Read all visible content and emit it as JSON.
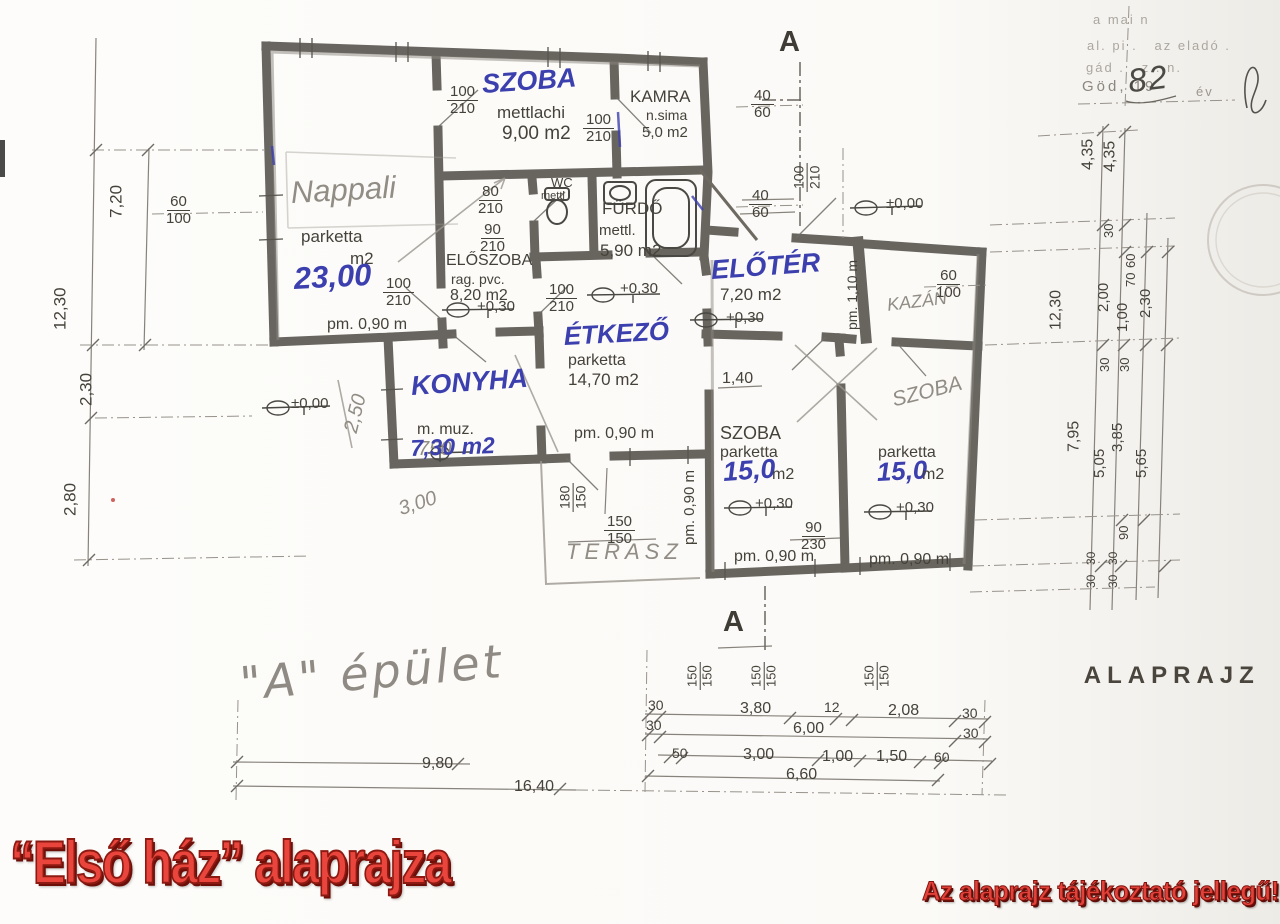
{
  "colors": {
    "red_text": "#e3423b",
    "red_shadow": "#7e120c",
    "blue_ink": "#3c3fae",
    "pencil_gray": "#918d85",
    "ink": "#45423a"
  },
  "footer": {
    "title": "“Első ház” alaprajza",
    "note": "Az alaprajz tájékoztató jellegű!"
  },
  "caption": {
    "label": "ALAPRAJZ",
    "scale": "( M"
  },
  "section_marker": "A",
  "building_label": "\"A\" épület",
  "scan_header": {
    "line1": "a mai n",
    "line2": "al. pi .   az eladó .",
    "line3": "gád . , z . n.",
    "date_prefix": "Göd, 19",
    "year": "82",
    "suffix": "év"
  },
  "annotations": [
    {
      "id": "szoba1-name",
      "text": "SZOBA",
      "x": 481,
      "y": 70,
      "size": 27,
      "cls": "blue",
      "rot": -4
    },
    {
      "id": "szoba1-finish",
      "text": "mettlachi",
      "x": 497,
      "y": 104,
      "size": 17
    },
    {
      "id": "szoba1-area",
      "text": "9,00 m2",
      "x": 502,
      "y": 124,
      "size": 19
    },
    {
      "id": "szoba1-door-size",
      "text": "100\n210",
      "x": 447,
      "y": 84,
      "size": 15,
      "frac": true
    },
    {
      "id": "kamra-door-size",
      "text": "100\n210",
      "x": 583,
      "y": 112,
      "size": 15,
      "frac": true
    },
    {
      "id": "kamra-name",
      "text": "KAMRA",
      "x": 630,
      "y": 88,
      "size": 17
    },
    {
      "id": "kamra-finish",
      "text": "n.sima",
      "x": 646,
      "y": 108,
      "size": 14
    },
    {
      "id": "kamra-area",
      "text": "5,0 m2",
      "x": 642,
      "y": 125,
      "size": 15
    },
    {
      "id": "nappali-name",
      "text": "Nappali",
      "x": 290,
      "y": 176,
      "size": 31,
      "cls": "pencil",
      "rot": -3
    },
    {
      "id": "nappali-finish",
      "text": "parketta",
      "x": 301,
      "y": 228,
      "size": 17
    },
    {
      "id": "nappali-area-unit",
      "text": "m2",
      "x": 350,
      "y": 250,
      "size": 17
    },
    {
      "id": "nappali-area",
      "text": "23,00",
      "x": 293,
      "y": 262,
      "size": 31,
      "cls": "blue",
      "rot": -3
    },
    {
      "id": "wc-door-size",
      "text": "80\n210",
      "x": 478,
      "y": 184,
      "size": 15,
      "frac": true
    },
    {
      "id": "wc-name",
      "text": "WC",
      "x": 551,
      "y": 176,
      "size": 13
    },
    {
      "id": "wc-finish",
      "text": "mettl",
      "x": 541,
      "y": 191,
      "size": 11
    },
    {
      "id": "furdo-name",
      "text": "FÜRDŐ",
      "x": 602,
      "y": 200,
      "size": 17
    },
    {
      "id": "furdo-finish",
      "text": "mettl.",
      "x": 599,
      "y": 223,
      "size": 15
    },
    {
      "id": "furdo-area",
      "text": "5,90 m2",
      "x": 600,
      "y": 242,
      "size": 17
    },
    {
      "id": "eloszoba-door-size",
      "text": "90\n210",
      "x": 480,
      "y": 222,
      "size": 15,
      "frac": true
    },
    {
      "id": "eloszoba-name",
      "text": "ELŐSZOBA",
      "x": 446,
      "y": 252,
      "size": 16
    },
    {
      "id": "eloszoba-finish",
      "text": "rag. pvc.",
      "x": 451,
      "y": 272,
      "size": 14
    },
    {
      "id": "eloszoba-area",
      "text": "8,20 m2",
      "x": 450,
      "y": 287,
      "size": 16
    },
    {
      "id": "eloszoba-level",
      "text": "+0,30",
      "x": 477,
      "y": 299,
      "size": 15
    },
    {
      "id": "nappali-door-size",
      "text": "100\n210",
      "x": 383,
      "y": 276,
      "size": 15,
      "frac": true
    },
    {
      "id": "etkezo-door-size",
      "text": "100\n210",
      "x": 546,
      "y": 282,
      "size": 15,
      "frac": true
    },
    {
      "id": "nappali-parapet",
      "text": "pm. 0,90 m",
      "x": 327,
      "y": 316,
      "size": 16
    },
    {
      "id": "etkezo-name",
      "text": "ÉTKEZŐ",
      "x": 563,
      "y": 322,
      "size": 26,
      "cls": "blue",
      "rot": -3
    },
    {
      "id": "etkezo-finish",
      "text": "parketta",
      "x": 568,
      "y": 352,
      "size": 16
    },
    {
      "id": "etkezo-area",
      "text": "14,70 m2",
      "x": 568,
      "y": 371,
      "size": 17
    },
    {
      "id": "etkezo-level",
      "text": "+0,30",
      "x": 620,
      "y": 281,
      "size": 15
    },
    {
      "id": "konyha-name",
      "text": "KONYHA",
      "x": 410,
      "y": 372,
      "size": 27,
      "cls": "blue",
      "rot": -4
    },
    {
      "id": "konyha-finish",
      "text": "m. muz.",
      "x": 417,
      "y": 421,
      "size": 16
    },
    {
      "id": "konyha-area-old",
      "text": "750",
      "x": 418,
      "y": 439,
      "size": 20,
      "cls": "pencil"
    },
    {
      "id": "konyha-area",
      "text": "7,30 m2",
      "x": 410,
      "y": 436,
      "size": 23,
      "cls": "blue",
      "rot": -2
    },
    {
      "id": "etkezo-parapet",
      "text": "pm. 0,90 m",
      "x": 574,
      "y": 425,
      "size": 16
    },
    {
      "id": "eloter-name",
      "text": "ELŐTÉR",
      "x": 710,
      "y": 256,
      "size": 27,
      "cls": "blue",
      "rot": -4
    },
    {
      "id": "eloter-area",
      "text": "7,20 m2",
      "x": 720,
      "y": 286,
      "size": 17
    },
    {
      "id": "eloter-level",
      "text": "+0,30",
      "x": 726,
      "y": 310,
      "size": 15
    },
    {
      "id": "entry-level",
      "text": "±0,00",
      "x": 886,
      "y": 196,
      "size": 15
    },
    {
      "id": "konyha-level",
      "text": "±0,00",
      "x": 291,
      "y": 396,
      "size": 15
    },
    {
      "id": "kazan-name",
      "text": "KAZÁN",
      "x": 886,
      "y": 296,
      "size": 18,
      "cls": "pencil",
      "rot": -7
    },
    {
      "id": "kazan-parapet",
      "text": "pm. 1,10 m",
      "x": 860,
      "y": 330,
      "size": 14,
      "rot": -90
    },
    {
      "id": "dim-4060-top",
      "text": "40\n60",
      "x": 751,
      "y": 88,
      "size": 15,
      "frac": true
    },
    {
      "id": "dim-4060-mid",
      "text": "40\n60",
      "x": 749,
      "y": 188,
      "size": 15,
      "frac": true
    },
    {
      "id": "kazan-window",
      "text": "60\n100",
      "x": 936,
      "y": 268,
      "size": 15,
      "frac": true
    },
    {
      "id": "eloter-door-size",
      "text": "100\n210",
      "x": 822,
      "y": 192,
      "size": 14,
      "frac": true,
      "rot": -90
    },
    {
      "id": "dim-140",
      "text": "1,40",
      "x": 722,
      "y": 370,
      "size": 16
    },
    {
      "id": "szoba2-name",
      "text": "SZOBA",
      "x": 720,
      "y": 424,
      "size": 18
    },
    {
      "id": "szoba2-finish",
      "text": "parketta",
      "x": 720,
      "y": 444,
      "size": 16
    },
    {
      "id": "szoba2-area",
      "text": "15,0",
      "x": 722,
      "y": 458,
      "size": 27,
      "cls": "blue",
      "rot": -4
    },
    {
      "id": "szoba2-area-unit",
      "text": "m2",
      "x": 772,
      "y": 466,
      "size": 16
    },
    {
      "id": "szoba3-name",
      "text": "SZOBA",
      "x": 890,
      "y": 390,
      "size": 21,
      "cls": "pencil",
      "rot": -14
    },
    {
      "id": "szoba3-finish",
      "text": "parketta",
      "x": 878,
      "y": 444,
      "size": 16
    },
    {
      "id": "szoba3-area",
      "text": "15,0",
      "x": 876,
      "y": 458,
      "size": 26,
      "cls": "blue",
      "rot": -3
    },
    {
      "id": "szoba3-area-unit",
      "text": "m2",
      "x": 922,
      "y": 466,
      "size": 16
    },
    {
      "id": "szoba2-level",
      "text": "+0,30",
      "x": 755,
      "y": 496,
      "size": 15
    },
    {
      "id": "szoba3-level",
      "text": "+0,30",
      "x": 896,
      "y": 500,
      "size": 15
    },
    {
      "id": "dim-90230",
      "text": "90\n230",
      "x": 801,
      "y": 520,
      "size": 15,
      "frac": true
    },
    {
      "id": "szoba2-parapet",
      "text": "pm. 0,90 m",
      "x": 734,
      "y": 548,
      "size": 16
    },
    {
      "id": "szoba3-parapet",
      "text": "pm. 0,90 m",
      "x": 869,
      "y": 551,
      "size": 16
    },
    {
      "id": "szoba2-parapet-side",
      "text": "pm. 0,90 m",
      "x": 698,
      "y": 545,
      "size": 15,
      "rot": -90
    },
    {
      "id": "terasz-name",
      "text": "TERASZ",
      "x": 566,
      "y": 540,
      "size": 22,
      "cls": "pencil",
      "spacing": 5
    },
    {
      "id": "terasz-dim-180150",
      "text": "180\n150",
      "x": 588,
      "y": 512,
      "size": 14,
      "frac": true,
      "rot": -90
    },
    {
      "id": "terasz-dim-150150",
      "text": "150\n150",
      "x": 604,
      "y": 514,
      "size": 15,
      "frac": true
    },
    {
      "id": "left-window",
      "text": "60\n100",
      "x": 166,
      "y": 194,
      "size": 15,
      "frac": true
    },
    {
      "id": "left-720",
      "text": "7,20",
      "x": 126,
      "y": 218,
      "size": 17,
      "rot": -90
    },
    {
      "id": "left-1230",
      "text": "12,30",
      "x": 70,
      "y": 330,
      "size": 17,
      "rot": -90
    },
    {
      "id": "left-230",
      "text": "2,30",
      "x": 96,
      "y": 406,
      "size": 17,
      "rot": -90
    },
    {
      "id": "left-280",
      "text": "2,80",
      "x": 80,
      "y": 516,
      "size": 17,
      "rot": -90
    },
    {
      "id": "pencil-250",
      "text": "2,50",
      "x": 341,
      "y": 430,
      "size": 20,
      "cls": "pencil",
      "rot": -76
    },
    {
      "id": "pencil-300",
      "text": "3,00",
      "x": 396,
      "y": 500,
      "size": 20,
      "cls": "pencil",
      "rot": -18
    },
    {
      "id": "right-435a",
      "text": "4,35",
      "x": 1097,
      "y": 170,
      "size": 16,
      "rot": -90
    },
    {
      "id": "right-435b",
      "text": "4,35",
      "x": 1119,
      "y": 172,
      "size": 16,
      "rot": -90
    },
    {
      "id": "right-1230",
      "text": "12,30",
      "x": 1065,
      "y": 330,
      "size": 16,
      "rot": -90
    },
    {
      "id": "right-30a",
      "text": "30",
      "x": 1116,
      "y": 238,
      "size": 13,
      "rot": -90
    },
    {
      "id": "right-200",
      "text": "2,00",
      "x": 1112,
      "y": 312,
      "size": 15,
      "rot": -90
    },
    {
      "id": "right-100",
      "text": "1,00",
      "x": 1131,
      "y": 332,
      "size": 15,
      "rot": -90
    },
    {
      "id": "right-60",
      "text": "60",
      "x": 1138,
      "y": 268,
      "size": 13,
      "rot": -90
    },
    {
      "id": "right-70",
      "text": "70",
      "x": 1138,
      "y": 287,
      "size": 13,
      "rot": -90
    },
    {
      "id": "right-230",
      "text": "2,30",
      "x": 1154,
      "y": 318,
      "size": 15,
      "rot": -90
    },
    {
      "id": "right-30b",
      "text": "30",
      "x": 1112,
      "y": 372,
      "size": 13,
      "rot": -90
    },
    {
      "id": "right-30c",
      "text": "30",
      "x": 1132,
      "y": 372,
      "size": 13,
      "rot": -90
    },
    {
      "id": "right-795",
      "text": "7,95",
      "x": 1083,
      "y": 452,
      "size": 16,
      "rot": -90
    },
    {
      "id": "right-505",
      "text": "5,05",
      "x": 1108,
      "y": 478,
      "size": 15,
      "rot": -90
    },
    {
      "id": "right-385",
      "text": "3,85",
      "x": 1126,
      "y": 452,
      "size": 15,
      "rot": -90
    },
    {
      "id": "right-565",
      "text": "5,65",
      "x": 1150,
      "y": 478,
      "size": 15,
      "rot": -90
    },
    {
      "id": "right-90",
      "text": "90",
      "x": 1131,
      "y": 540,
      "size": 13,
      "rot": -90
    },
    {
      "id": "right-30d",
      "text": "30",
      "x": 1098,
      "y": 565,
      "size": 12,
      "rot": -90
    },
    {
      "id": "right-30e",
      "text": "30",
      "x": 1120,
      "y": 565,
      "size": 12,
      "rot": -90
    },
    {
      "id": "right-30f",
      "text": "30",
      "x": 1098,
      "y": 588,
      "size": 12,
      "rot": -90
    },
    {
      "id": "right-30g",
      "text": "30",
      "x": 1120,
      "y": 588,
      "size": 12,
      "rot": -90
    },
    {
      "id": "bottom-150150-a",
      "text": "150\n150",
      "x": 714,
      "y": 690,
      "size": 13,
      "frac": true,
      "rot": -90
    },
    {
      "id": "bottom-150150-b",
      "text": "150\n150",
      "x": 778,
      "y": 690,
      "size": 13,
      "frac": true,
      "rot": -90
    },
    {
      "id": "bottom-150150-c",
      "text": "150\n150",
      "x": 891,
      "y": 690,
      "size": 13,
      "frac": true,
      "rot": -90
    },
    {
      "id": "bottom-30a",
      "text": "30",
      "x": 648,
      "y": 698,
      "size": 14
    },
    {
      "id": "bottom-380",
      "text": "3,80",
      "x": 740,
      "y": 700,
      "size": 16
    },
    {
      "id": "bottom-12",
      "text": "12",
      "x": 824,
      "y": 700,
      "size": 14
    },
    {
      "id": "bottom-208",
      "text": "2,08",
      "x": 888,
      "y": 702,
      "size": 16
    },
    {
      "id": "bottom-30b",
      "text": "30",
      "x": 962,
      "y": 706,
      "size": 14
    },
    {
      "id": "bottom-30c",
      "text": "30",
      "x": 646,
      "y": 718,
      "size": 14
    },
    {
      "id": "bottom-600",
      "text": "6,00",
      "x": 793,
      "y": 720,
      "size": 16
    },
    {
      "id": "bottom-30d",
      "text": "30",
      "x": 963,
      "y": 726,
      "size": 14
    },
    {
      "id": "bottom-50",
      "text": "50",
      "x": 672,
      "y": 746,
      "size": 14
    },
    {
      "id": "bottom-300",
      "text": "3,00",
      "x": 743,
      "y": 746,
      "size": 16
    },
    {
      "id": "bottom-100",
      "text": "1,00",
      "x": 822,
      "y": 748,
      "size": 16
    },
    {
      "id": "bottom-150",
      "text": "1,50",
      "x": 876,
      "y": 748,
      "size": 16
    },
    {
      "id": "bottom-60",
      "text": "60",
      "x": 934,
      "y": 750,
      "size": 14
    },
    {
      "id": "bottom-660",
      "text": "6,60",
      "x": 786,
      "y": 766,
      "size": 16
    },
    {
      "id": "bottom-980",
      "text": "9,80",
      "x": 422,
      "y": 755,
      "size": 16
    },
    {
      "id": "bottom-1640",
      "text": "16,40",
      "x": 514,
      "y": 778,
      "size": 16
    }
  ]
}
